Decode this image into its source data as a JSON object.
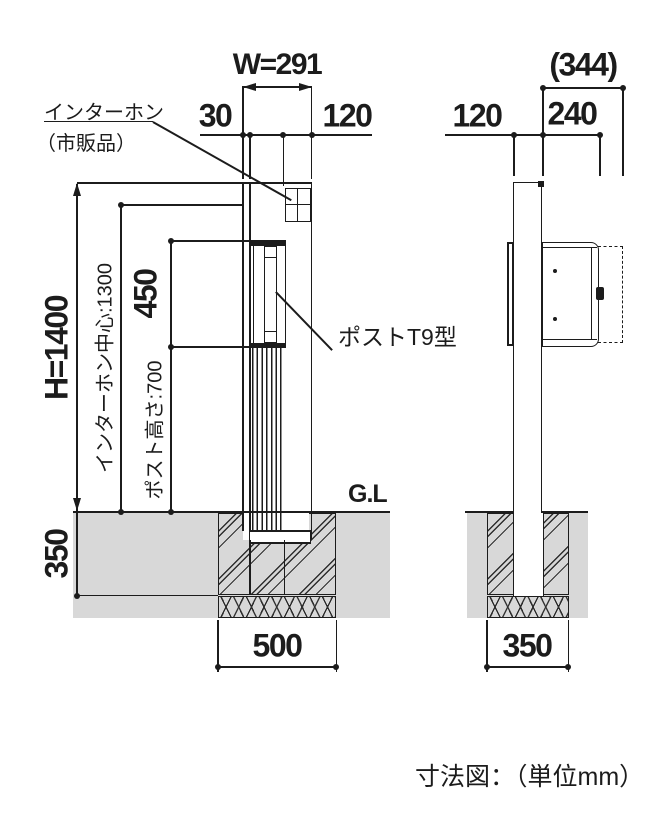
{
  "figure_caption": "寸法図：（単位mm）",
  "front_view": {
    "labels": {
      "intercom_name": "インターホン",
      "intercom_note": "（市販品）",
      "post_model": "ポストT9型",
      "ground_level": "G.L"
    },
    "dims": {
      "width": "W=291",
      "edge_offset": "30",
      "intercom_offset": "120",
      "total_height": "H=1400",
      "intercom_center_height": "インターホン中心:1300",
      "post_box_height": "450",
      "post_height": "ポスト高さ:700",
      "embed_depth": "350",
      "footing_width": "500"
    }
  },
  "side_view": {
    "dims": {
      "post_depth": "120",
      "box_depth": "240",
      "overall_depth": "(344)",
      "footing_width": "350"
    }
  },
  "colors": {
    "line": "#1c1c1c",
    "ground": "#d8d8d8"
  }
}
